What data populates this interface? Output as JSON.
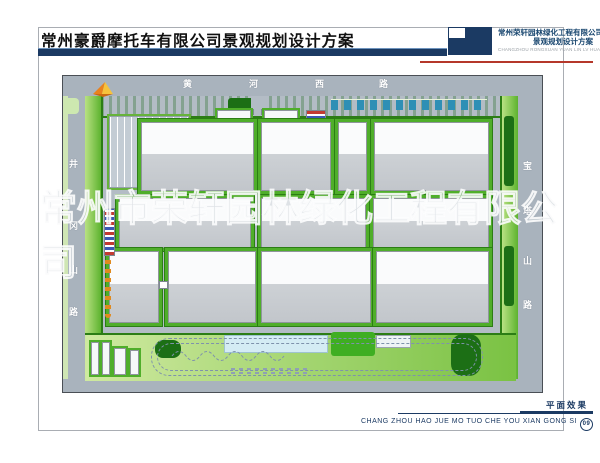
{
  "header": {
    "title": "常州豪爵摩托车有限公司景观规划设计方案",
    "company": "常州荣轩园林绿化工程有限公司",
    "subtitle": "景观规划设计方案",
    "company_pinyin": "CHANGZHOU RONGXUAN YUAN LIN LV HUA"
  },
  "watermark": {
    "text": "常州市荣轩园林绿化工程有限公司"
  },
  "map": {
    "roads": {
      "top": {
        "name": "黄河西路",
        "chars": [
          "黄",
          "河",
          "西",
          "路"
        ]
      },
      "left": {
        "name": "井冈山路",
        "chars": [
          "井",
          "冈",
          "山",
          "路"
        ]
      },
      "right": {
        "name": "宝塔山路",
        "chars": [
          "宝",
          "塔",
          "山",
          "路"
        ]
      }
    }
  },
  "footer": {
    "view_label": "平面效果",
    "pinyin": "CHANG ZHOU HAO JUE MO TUO CHE YOU XIAN GONG SI",
    "page_number": "09"
  },
  "colors": {
    "navy": "#1b3a63",
    "accent_red": "#b5372a",
    "road_gray": "#a9b3bd",
    "green": "#5db32f",
    "dark_green": "#1c6f15",
    "building_top": "#fafbfc",
    "building_bottom": "#c2c6cb",
    "pool_blue": "#d4ecf4"
  }
}
